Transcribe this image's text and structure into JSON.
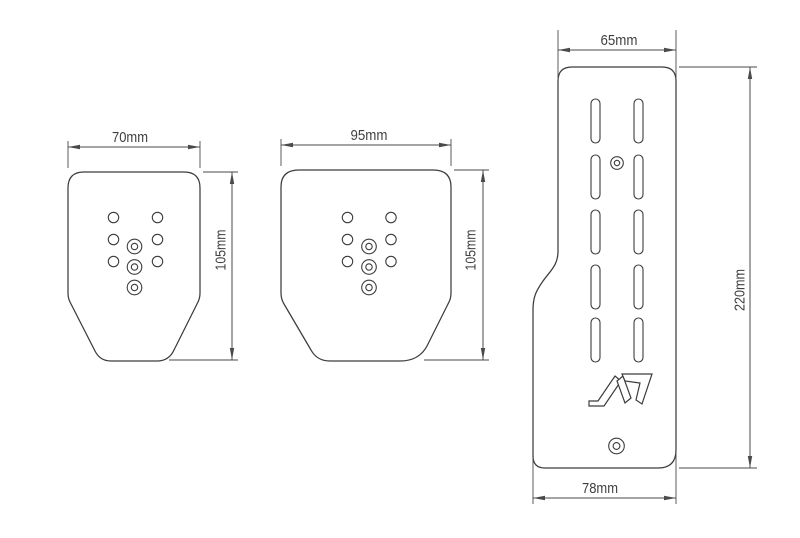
{
  "drawing": {
    "background": "#ffffff",
    "line_color": "#3c3c3c",
    "dimension_color": "#4a4a4a",
    "logo_icon": "stylized-n-brand-logo",
    "pedals": {
      "left": {
        "width_label": "70mm",
        "height_label": "105mm",
        "small_holes": 6,
        "target_holes": 3
      },
      "middle": {
        "width_label": "95mm",
        "height_label": "105mm",
        "small_holes": 6,
        "target_holes": 3
      },
      "right": {
        "top_width_label": "65mm",
        "bottom_width_label": "78mm",
        "height_label": "220mm",
        "slots": 10,
        "target_holes": 2
      }
    }
  }
}
